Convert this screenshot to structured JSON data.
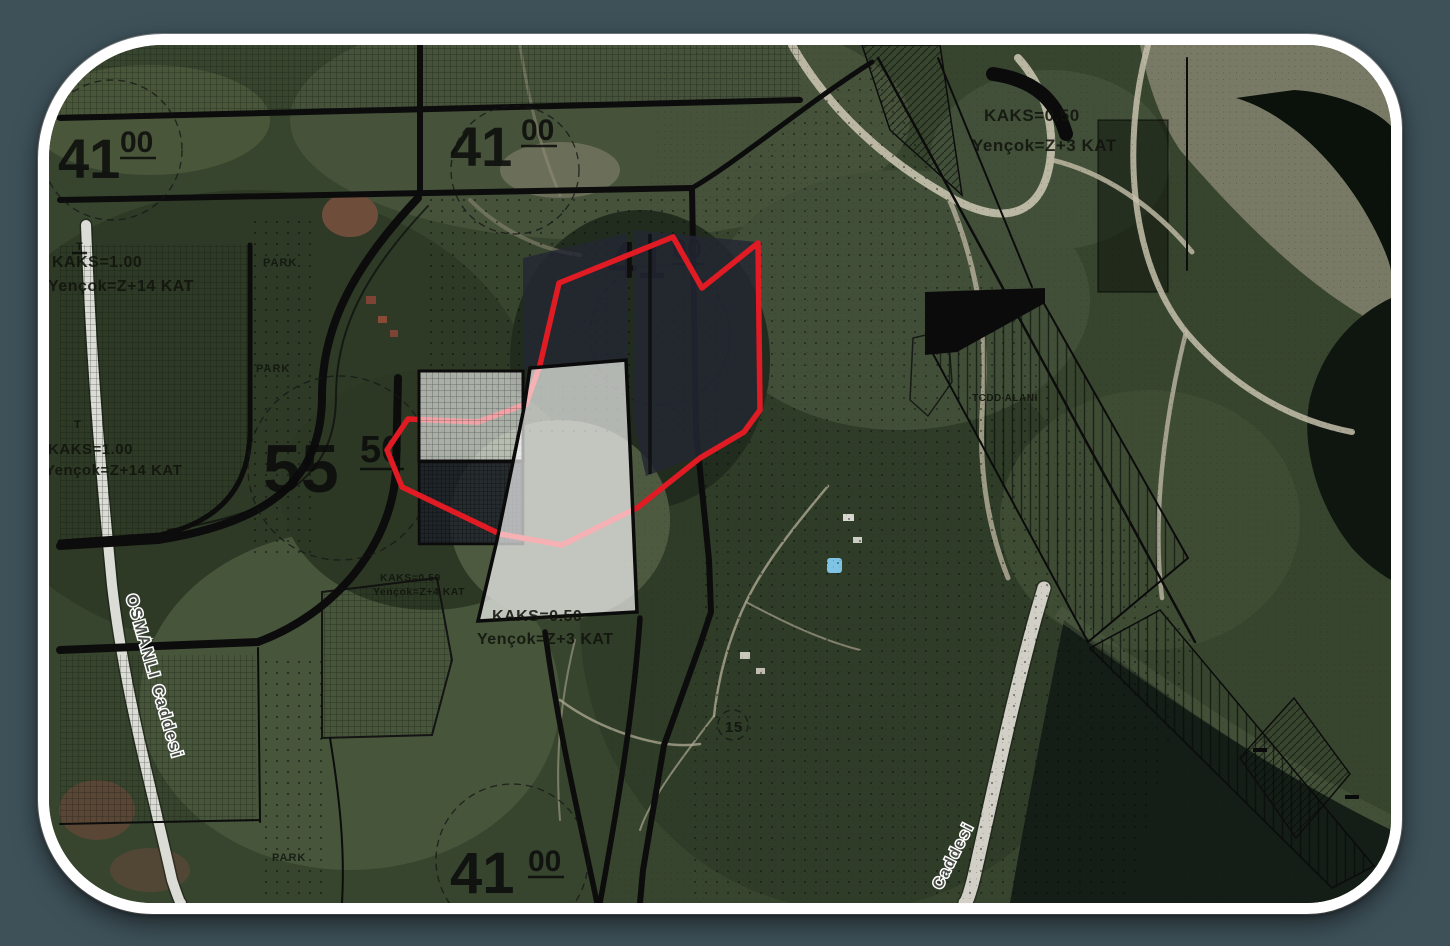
{
  "window": {
    "kind": "satellite-map-with-zoning-plan-overlay",
    "background_color": "#3e5159",
    "frame_color": "#ffffff"
  },
  "map": {
    "blocks": [
      {
        "id": "block-41-top-left",
        "number": "41",
        "sub": "00"
      },
      {
        "id": "block-41-top-center",
        "number": "41",
        "sub": "00"
      },
      {
        "id": "block-41-center",
        "number": "41",
        "sub": "00"
      },
      {
        "id": "block-41-bottom",
        "number": "41",
        "sub": "00"
      },
      {
        "id": "block-55-west",
        "number": "55",
        "sub": "50"
      }
    ],
    "zoning_labels": [
      {
        "id": "zoning-west-upper",
        "kaks": "KAKS=1.00",
        "height": "Yençok=Z+14 KAT"
      },
      {
        "id": "zoning-west-lower",
        "kaks": "KAKS=1.00",
        "height": "Yençok=Z+14 KAT"
      },
      {
        "id": "zoning-northeast",
        "kaks": "KAKS=0.50",
        "height": "Yençok=Z+3 KAT"
      },
      {
        "id": "zoning-center-small",
        "kaks": "KAKS=0.50",
        "height": "Yençok=Z+4 KAT"
      },
      {
        "id": "zoning-center-bottom",
        "kaks": "KAKS=0.50",
        "height": "Yençok=Z+3 KAT"
      }
    ],
    "area_labels": {
      "park": "PARK",
      "tcdd": "TCDD ALANI",
      "road_number": "15",
      "survey_mark": "T"
    },
    "streets": {
      "west": "OSMANLI Caddesi",
      "southeast": "Caddesi"
    },
    "colors": {
      "selected_parcel_outline": "#e01b24",
      "parcel_highlight_fill": "#ffffff",
      "overlay_dark": "#232733",
      "plan_linework": "#0c0c0c",
      "terrain_green": "#3a4730",
      "water": "#0c130e",
      "sand": "#a59f8c",
      "road_light": "#dcdcd6",
      "pool_marker": "#7fc4e4"
    }
  }
}
